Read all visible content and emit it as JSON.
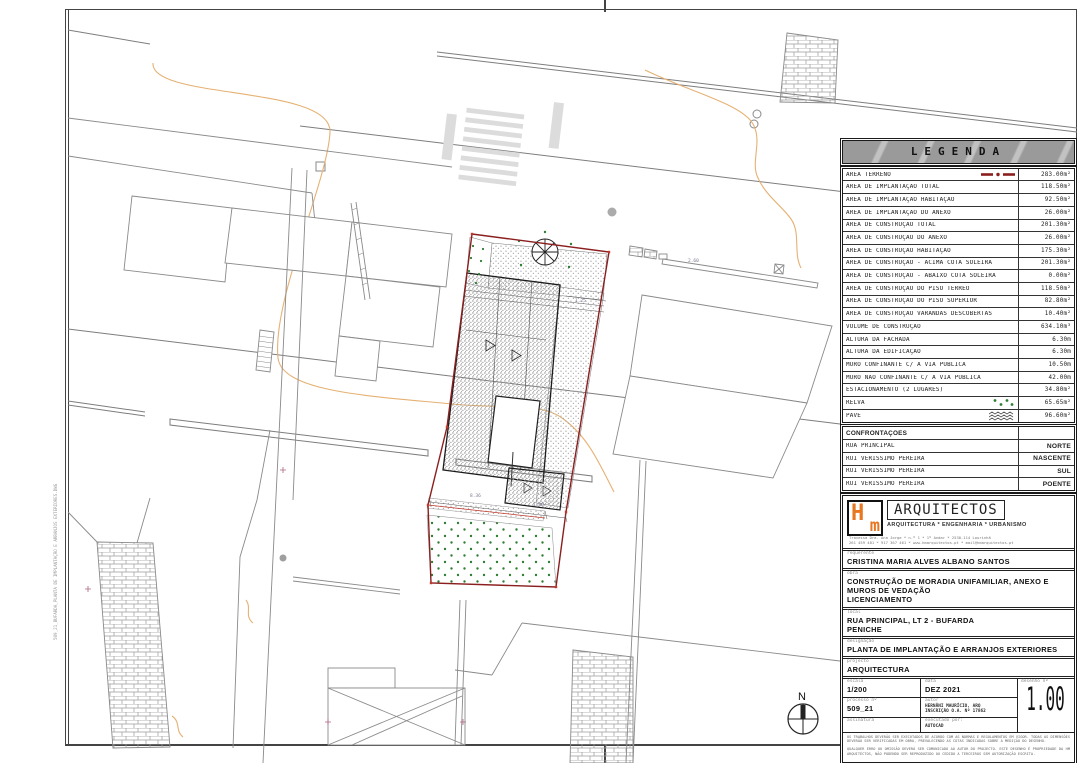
{
  "legend": {
    "title": "LEGENDA",
    "rows": [
      {
        "label": "ÁREA TERRENO",
        "value": "283.00m²",
        "symbol": "boundary"
      },
      {
        "label": "ÁREA DE IMPLANTAÇÃO TOTAL",
        "value": "118.50m²"
      },
      {
        "label": "ÁREA DE IMPLANTAÇÃO HABITAÇÃO",
        "value": "92.50m²"
      },
      {
        "label": "ÁREA DE IMPLANTAÇÃO DO ANEXO",
        "value": "26.00m²"
      },
      {
        "label": "ÁREA DE CONSTRUÇÃO TOTAL",
        "value": "201.30m²"
      },
      {
        "label": "ÁREA DE CONSTRUÇÃO DO ANEXO",
        "value": "26.00m²"
      },
      {
        "label": "ÁREA DE CONSTRUÇÃO HABITAÇÃO",
        "value": "175.30m²"
      },
      {
        "label": "ÁREA DE CONSTRUÇÃO - ACIMA COTA SOLEIRA",
        "value": "201.30m²"
      },
      {
        "label": "ÁREA DE CONSTRUÇÃO - ABAIXO COTA SOLEIRA",
        "value": "0.00m²"
      },
      {
        "label": "ÁREA DE CONSTRUÇÃO DO PISO TÉRREO",
        "value": "118.50m²"
      },
      {
        "label": "ÁREA DE CONSTRUÇÃO DO PISO SUPERIOR",
        "value": "82.80m²"
      },
      {
        "label": "ÁREA DE CONSTRUÇÃO VARANDAS DESCOBERTAS",
        "value": "10.40m²"
      },
      {
        "label": "VOLUME DE CONSTRUÇÃO",
        "value": "634.10m³"
      },
      {
        "label": "ALTURA DA FACHADA",
        "value": "6.30m"
      },
      {
        "label": "ALTURA DA EDIFICAÇÃO",
        "value": "6.30m"
      },
      {
        "label": "MURO CONFINANTE C/ A VIA PÚBLICA",
        "value": "10.50m"
      },
      {
        "label": "MURO NÃO CONFINANTE C/ A VIA PÚBLICA",
        "value": "42.00m"
      },
      {
        "label": "ESTACIONAMENTO (2 LUGARES)",
        "value": "34.80m²"
      },
      {
        "label": "RELVA",
        "value": "65.65m²",
        "symbol": "grass"
      },
      {
        "label": "PAVÊ",
        "value": "96.60m²",
        "symbol": "pave"
      }
    ]
  },
  "confrontations": {
    "title": "CONFRONTAÇÕES",
    "rows": [
      {
        "label": "RUA PRINCIPAL",
        "value": "NORTE"
      },
      {
        "label": "RUI VERISSIMO PEREIRA",
        "value": "NASCENTE"
      },
      {
        "label": "RUI VERISSIMO PEREIRA",
        "value": "SUL"
      },
      {
        "label": "RUI VERISSIMO PEREIRA",
        "value": "POENTE"
      }
    ]
  },
  "firm": {
    "logo_h": "H",
    "logo_m": "m",
    "name": "ARQUITECTOS",
    "tagline": "ARQUITECTURA * ENGENHARIA * URBANISMO",
    "address1": "Travessa Dra. Ana Jorge * n.º 1 * 1º Andar * 2530-114 Lourinhã",
    "address2": "261 459 481 * 917 367 461 * www.hmarquitectos.pt * mail@hmarquitectos.pt"
  },
  "titleblock": {
    "requerente_label": "requerente",
    "requerente": "CRISTINA MARIA ALVES ALBANO SANTOS",
    "obra_label": "obra",
    "obra_line1": "CONSTRUÇÃO DE MORADIA UNIFAMILIAR, ANEXO E MUROS DE VEDAÇÃO",
    "obra_line2": "LICENCIAMENTO",
    "local_label": "local",
    "local_line1": "RUA PRINCIPAL, LT 2 - BUFARDA",
    "local_line2": "PENICHE",
    "designacao_label": "designação",
    "designacao": "PLANTA DE IMPLANTAÇÃO E ARRANJOS EXTERIORES",
    "projecto_label": "projecto",
    "projecto": "ARQUITECTURA",
    "escala_label": "escala",
    "escala": "1/200",
    "data_label": "data",
    "data": "DEZ 2021",
    "desenho_label": "desenho nº",
    "desenho": "1.00",
    "processo_label": "processo nº",
    "processo": "509_21",
    "autor_label": "autor",
    "autor_line1": "HERNÂNI MAURÍCIO, ARQ",
    "autor_line2": "INSCRIÇÃO O.A. Nº 17862",
    "assinatura_label": "assinatura",
    "executado_label": "executado por:",
    "executado": "AUTOCAD",
    "note1": "OS TRABALHOS DEVERÃO SER EXECUTADOS DE ACORDO COM AS NORMAS E REGULAMENTOS EM VIGOR. TODAS AS DIMENSÕES DEVERÃO SER VERIFICADAS EM OBRA, PREVALECENDO AS COTAS INDICADAS SOBRE A MEDIÇÃO DO DESENHO.",
    "note2": "QUALQUER ERRO OU OMISSÃO DEVERÁ SER COMUNICADO AO AUTOR DO PROJECTO. ESTE DESENHO É PROPRIEDADE DA HM ARQUITECTOS, NÃO PODENDO SER REPRODUZIDO OU CEDIDO A TERCEIROS SEM AUTORIZAÇÃO ESCRITA."
  },
  "plan": {
    "north_label": "N",
    "side_note": "509_21_BUFARDA_PLANTA DE IMPLANTAÇÃO E ARRANJOS EXTERIORES.DWG",
    "annotations": [
      {
        "text": "8.36",
        "x": 470,
        "y": 497
      },
      {
        "text": "1.86",
        "x": 533,
        "y": 506
      },
      {
        "text": "1.25",
        "x": 575,
        "y": 302
      },
      {
        "text": "2.60",
        "x": 688,
        "y": 262
      }
    ]
  },
  "colors": {
    "boundary_red": "#8b1f1f",
    "grass_green": "#2f7d32",
    "contour_orange": "#e6b173",
    "logo_orange": "#e87722"
  }
}
